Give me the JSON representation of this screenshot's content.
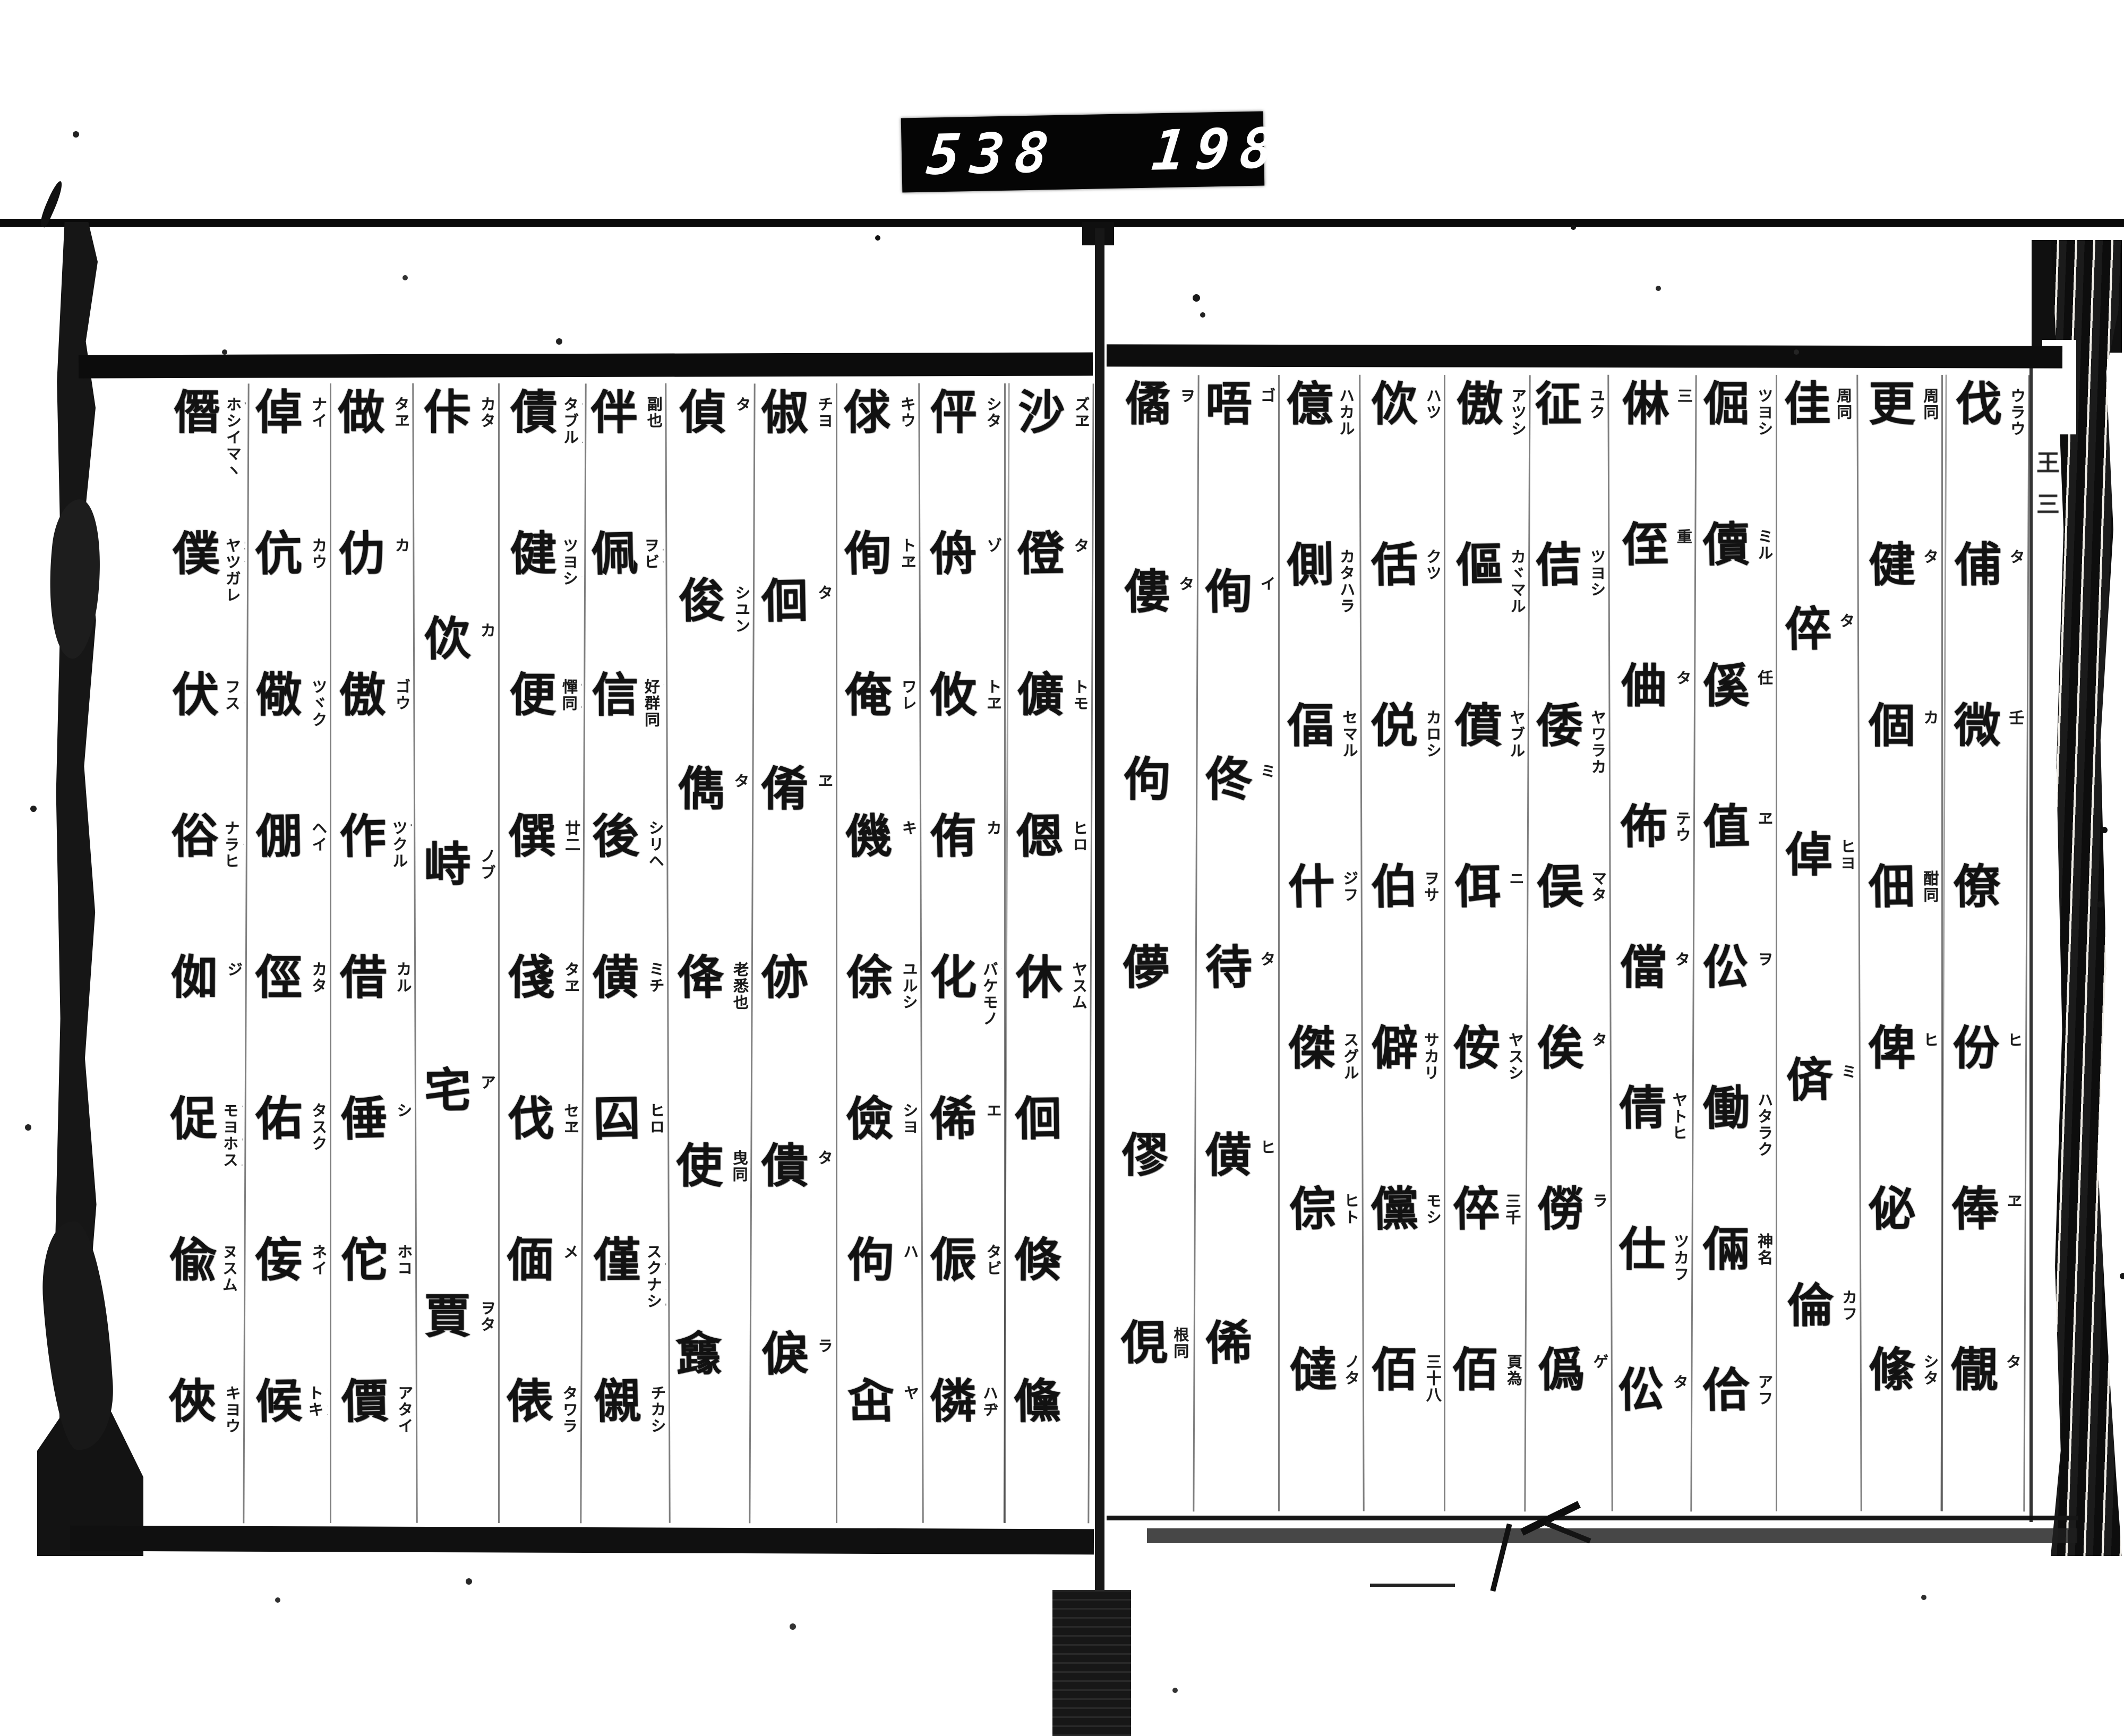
{
  "counter": {
    "left_value": "538",
    "right_value": "198."
  },
  "colors": {
    "ink": "#121212",
    "paper": "#ffffff",
    "counter_bg": "#050505",
    "counter_digits": "#ffffff"
  },
  "fold_marks": [
    {
      "text": "王"
    },
    {
      "text": "三"
    }
  ],
  "spread": {
    "right_page": {
      "columns": [
        {
          "entries": [
            {
              "k": "伐",
              "r": [
                "ウラウ"
              ]
            },
            {
              "k": "俌",
              "r": [
                "タ"
              ]
            },
            {
              "k": "微",
              "r": [
                "壬"
              ]
            },
            {
              "k": "僚",
              "r": []
            },
            {
              "k": "份",
              "r": [
                "ヒ"
              ]
            },
            {
              "k": "俸",
              "r": [
                "ヱ"
              ]
            },
            {
              "k": "儬",
              "r": [
                "タ"
              ]
            }
          ]
        },
        {
          "entries": [
            {
              "k": "更",
              "r": [
                "周同"
              ]
            },
            {
              "k": "健",
              "r": [
                "タ"
              ]
            },
            {
              "k": "個",
              "r": [
                "カ"
              ]
            },
            {
              "k": "佃",
              "r": [
                "酣同"
              ]
            },
            {
              "k": "俾",
              "r": [
                "ヒ"
              ]
            },
            {
              "k": "佖",
              "r": []
            },
            {
              "k": "絛",
              "r": [
                "シタ"
              ]
            }
          ]
        },
        {
          "entries": [
            {
              "k": "佳",
              "r": [
                "子サ",
                "周同"
              ]
            },
            {
              "k": "倅",
              "r": [
                "タ"
              ]
            },
            {
              "k": "倬",
              "r": [
                "ヒヨ"
              ]
            },
            {
              "k": "㑪",
              "r": [
                "ミ"
              ]
            },
            {
              "k": "倫",
              "r": [
                "カフ"
              ]
            }
          ]
        },
        {
          "entries": [
            {
              "k": "倔",
              "r": [
                "ツヨシ"
              ]
            },
            {
              "k": "儥",
              "r": [
                "ミル"
              ]
            },
            {
              "k": "傒",
              "r": [
                "任"
              ]
            },
            {
              "k": "值",
              "r": [
                "ヱ"
              ]
            },
            {
              "k": "伀",
              "r": [
                "ヲ"
              ]
            },
            {
              "k": "働",
              "r": [
                "ハタラク"
              ]
            },
            {
              "k": "倆",
              "r": [
                "神名"
              ]
            },
            {
              "k": "佮",
              "r": [
                "アフ"
              ]
            }
          ]
        },
        {
          "entries": [
            {
              "k": "㑣",
              "r": [
                "三"
              ]
            },
            {
              "k": "侄",
              "r": [
                "重"
              ]
            },
            {
              "k": "㑋",
              "r": [
                "タ"
              ]
            },
            {
              "k": "佈",
              "r": [
                "テウ"
              ]
            },
            {
              "k": "儅",
              "r": [
                "タ"
              ]
            },
            {
              "k": "倩",
              "r": [
                "ツラク",
                "ヤトヒ"
              ]
            },
            {
              "k": "仕",
              "r": [
                "ツカフ"
              ]
            },
            {
              "k": "伀",
              "r": [
                "タ"
              ]
            }
          ]
        },
        {
          "entries": [
            {
              "k": "征",
              "r": [
                "ユク"
              ]
            },
            {
              "k": "佶",
              "r": [
                "ツヨシ"
              ]
            },
            {
              "k": "倭",
              "r": [
                "ヤワラカ"
              ]
            },
            {
              "k": "俣",
              "r": [
                "マタ"
              ]
            },
            {
              "k": "俟",
              "r": [
                "タ"
              ]
            },
            {
              "k": "僗",
              "r": [
                "ラ"
              ]
            },
            {
              "k": "僞",
              "r": [
                "ゲ"
              ]
            }
          ]
        },
        {
          "entries": [
            {
              "k": "傲",
              "r": [
                "アツシ"
              ]
            },
            {
              "k": "傴",
              "r": [
                "カヾマル"
              ]
            },
            {
              "k": "僨",
              "r": [
                "ヤブル"
              ]
            },
            {
              "k": "佴",
              "r": [
                "ニ"
              ]
            },
            {
              "k": "侒",
              "r": [
                "ヤスシ"
              ]
            },
            {
              "k": "倅",
              "r": [
                "モチ",
                "三千"
              ]
            },
            {
              "k": "佰",
              "r": [
                "頁為"
              ]
            }
          ]
        },
        {
          "entries": [
            {
              "k": "佽",
              "r": [
                "ハツ"
              ]
            },
            {
              "k": "佸",
              "r": [
                "クツ"
              ]
            },
            {
              "k": "侻",
              "r": [
                "カロシ"
              ]
            },
            {
              "k": "伯",
              "r": [
                "ハク",
                "ヲサ"
              ]
            },
            {
              "k": "僻",
              "r": [
                "ヘキ",
                "サカリ"
              ]
            },
            {
              "k": "儻",
              "r": [
                "モシ"
              ]
            },
            {
              "k": "佰",
              "r": [
                "三十八"
              ]
            }
          ]
        },
        {
          "entries": [
            {
              "k": "億",
              "r": [
                "イヨク",
                "ハカル"
              ]
            },
            {
              "k": "側",
              "r": [
                "ソバ",
                "カタハラ"
              ]
            },
            {
              "k": "偪",
              "r": [
                "セマル"
              ]
            },
            {
              "k": "什",
              "r": [
                "ジフ"
              ]
            },
            {
              "k": "傑",
              "r": [
                "スグル"
              ]
            },
            {
              "k": "倧",
              "r": [
                "ヒト"
              ]
            },
            {
              "k": "㒓",
              "r": [
                "ノタ"
              ]
            }
          ]
        },
        {
          "entries": [
            {
              "k": "唔",
              "r": [
                "ゴ"
              ]
            },
            {
              "k": "侚",
              "r": [
                "イ"
              ]
            },
            {
              "k": "佟",
              "r": [
                "ミ"
              ]
            },
            {
              "k": "待",
              "r": [
                "タ"
              ]
            },
            {
              "k": "僙",
              "r": [
                "ヒ"
              ]
            },
            {
              "k": "俙",
              "r": []
            }
          ]
        },
        {
          "entries": [
            {
              "k": "僪",
              "r": [
                "ヲ"
              ]
            },
            {
              "k": "僂",
              "r": [
                "タ"
              ]
            },
            {
              "k": "佝",
              "r": []
            },
            {
              "k": "儚",
              "r": []
            },
            {
              "k": "僇",
              "r": []
            },
            {
              "k": "俔",
              "r": [
                "コヽ",
                "根同"
              ]
            }
          ]
        }
      ]
    },
    "left_page": {
      "columns": [
        {
          "entries": [
            {
              "k": "沙",
              "r": [
                "ズヱ"
              ]
            },
            {
              "k": "僜",
              "r": [
                "タ"
              ]
            },
            {
              "k": "儣",
              "r": [
                "トモ"
              ]
            },
            {
              "k": "𫣆",
              "r": [
                "ヒロ"
              ]
            },
            {
              "k": "休",
              "r": [
                "ヤスム"
              ]
            },
            {
              "k": "佪",
              "r": []
            },
            {
              "k": "倏",
              "r": []
            },
            {
              "k": "儵",
              "r": []
            }
          ]
        },
        {
          "entries": [
            {
              "k": "伻",
              "r": [
                "シタ"
              ]
            },
            {
              "k": "侜",
              "r": [
                "ゾ"
              ]
            },
            {
              "k": "攸",
              "r": [
                "トヱ"
              ]
            },
            {
              "k": "侑",
              "r": [
                "カ"
              ]
            },
            {
              "k": "化",
              "r": [
                "クワ",
                "バケモノ"
              ]
            },
            {
              "k": "俙",
              "r": [
                "エ"
              ]
            },
            {
              "k": "侲",
              "r": [
                "タビ"
              ]
            },
            {
              "k": "僯",
              "r": [
                "リン",
                "ハヂ"
              ]
            }
          ]
        },
        {
          "entries": [
            {
              "k": "俅",
              "r": [
                "キウ"
              ]
            },
            {
              "k": "侚",
              "r": [
                "トヱ"
              ]
            },
            {
              "k": "俺",
              "r": [
                "ワレ"
              ]
            },
            {
              "k": "僟",
              "r": [
                "キ"
              ]
            },
            {
              "k": "俆",
              "r": [
                "ユルシ"
              ]
            },
            {
              "k": "儉",
              "r": [
                "シヨ"
              ]
            },
            {
              "k": "佝",
              "r": [
                "ハ"
              ]
            },
            {
              "k": "㒴",
              "r": [
                "ヤ"
              ]
            }
          ]
        },
        {
          "entries": [
            {
              "k": "俶",
              "r": [
                "チヨ"
              ]
            },
            {
              "k": "佪",
              "r": [
                "タ"
              ]
            },
            {
              "k": "倄",
              "r": [
                "ヱ"
              ]
            },
            {
              "k": "㑊",
              "r": []
            },
            {
              "k": "僓",
              "r": [
                "タ"
              ]
            },
            {
              "k": "㑦",
              "r": [
                "ラ"
              ]
            }
          ]
        },
        {
          "entries": [
            {
              "k": "偵",
              "r": [
                "タ"
              ]
            },
            {
              "k": "俊",
              "r": [
                "シユン"
              ]
            },
            {
              "k": "儁",
              "r": [
                "タ"
              ]
            },
            {
              "k": "佭",
              "r": [
                "老悉也"
              ]
            },
            {
              "k": "使",
              "r": [
                "曳同"
              ]
            },
            {
              "k": "㒪",
              "r": []
            }
          ]
        },
        {
          "entries": [
            {
              "k": "伴",
              "r": [
                "副也"
              ]
            },
            {
              "k": "佩",
              "r": [
                "ハイ",
                "ヲビ"
              ]
            },
            {
              "k": "信",
              "r": [
                "シン",
                "好群同"
              ]
            },
            {
              "k": "後",
              "r": [
                "シリヘ"
              ]
            },
            {
              "k": "僙",
              "r": [
                "ミチ"
              ]
            },
            {
              "k": "囜",
              "r": [
                "ヒロ"
              ]
            },
            {
              "k": "僅",
              "r": [
                "キン",
                "ワヅカニ",
                "スクナシ"
              ]
            },
            {
              "k": "儭",
              "r": [
                "チカシ"
              ]
            }
          ]
        },
        {
          "entries": [
            {
              "k": "債",
              "r": [
                "タヾル",
                "タブル"
              ]
            },
            {
              "k": "健",
              "r": [
                "コワシ",
                "ツヨシ"
              ]
            },
            {
              "k": "便",
              "r": [
                "ナニ",
                "憚同"
              ]
            },
            {
              "k": "僎",
              "r": [
                "廿二"
              ]
            },
            {
              "k": "俴",
              "r": [
                "タヱ"
              ]
            },
            {
              "k": "伐",
              "r": [
                "セヱ"
              ]
            },
            {
              "k": "偭",
              "r": [
                "メ"
              ]
            },
            {
              "k": "俵",
              "r": [
                "タワラ"
              ]
            }
          ]
        },
        {
          "entries": [
            {
              "k": "佧",
              "r": [
                "カタ"
              ]
            },
            {
              "k": "佽",
              "r": [
                "カ"
              ]
            },
            {
              "k": "峙",
              "r": [
                "ノブ"
              ]
            },
            {
              "k": "宅",
              "r": [
                "ア"
              ]
            },
            {
              "k": "賈",
              "r": [
                "ヲタ"
              ]
            }
          ]
        },
        {
          "entries": [
            {
              "k": "做",
              "r": [
                "タヱ"
              ]
            },
            {
              "k": "仂",
              "r": [
                "カ"
              ]
            },
            {
              "k": "傲",
              "r": [
                "ゴウ"
              ]
            },
            {
              "k": "作",
              "r": [
                "サ",
                "ツクル"
              ]
            },
            {
              "k": "借",
              "r": [
                "カル"
              ]
            },
            {
              "k": "倕",
              "r": [
                "シ"
              ]
            },
            {
              "k": "佗",
              "r": [
                "ホコ"
              ]
            },
            {
              "k": "價",
              "r": [
                "アタイ"
              ]
            }
          ]
        },
        {
          "entries": [
            {
              "k": "倬",
              "r": [
                "ナイ"
              ]
            },
            {
              "k": "伉",
              "r": [
                "カウ"
              ]
            },
            {
              "k": "儆",
              "r": [
                "ツヾク"
              ]
            },
            {
              "k": "倗",
              "r": [
                "ヘイ"
              ]
            },
            {
              "k": "俓",
              "r": [
                "カタ"
              ]
            },
            {
              "k": "佑",
              "r": [
                "タスク"
              ]
            },
            {
              "k": "侫",
              "r": [
                "ネイ"
              ]
            },
            {
              "k": "候",
              "r": [
                "サブラフ",
                "ウカヾフ",
                "トキ"
              ]
            }
          ]
        },
        {
          "entries": [
            {
              "k": "僭",
              "r": [
                "セン",
                "ホシイマヽ"
              ]
            },
            {
              "k": "僕",
              "r": [
                "ボク",
                "ヤツガレ"
              ]
            },
            {
              "k": "伏",
              "r": [
                "フク",
                "フス"
              ]
            },
            {
              "k": "俗",
              "r": [
                "ゾク",
                "ナラヒ"
              ]
            },
            {
              "k": "侞",
              "r": [
                "ジ"
              ]
            },
            {
              "k": "促",
              "r": [
                "ソク",
                "ツヾマル",
                "モヨホス"
              ]
            },
            {
              "k": "偸",
              "r": [
                "トウ",
                "ヌスム"
              ]
            },
            {
              "k": "俠",
              "r": [
                "キヨウ"
              ]
            }
          ]
        }
      ]
    }
  }
}
